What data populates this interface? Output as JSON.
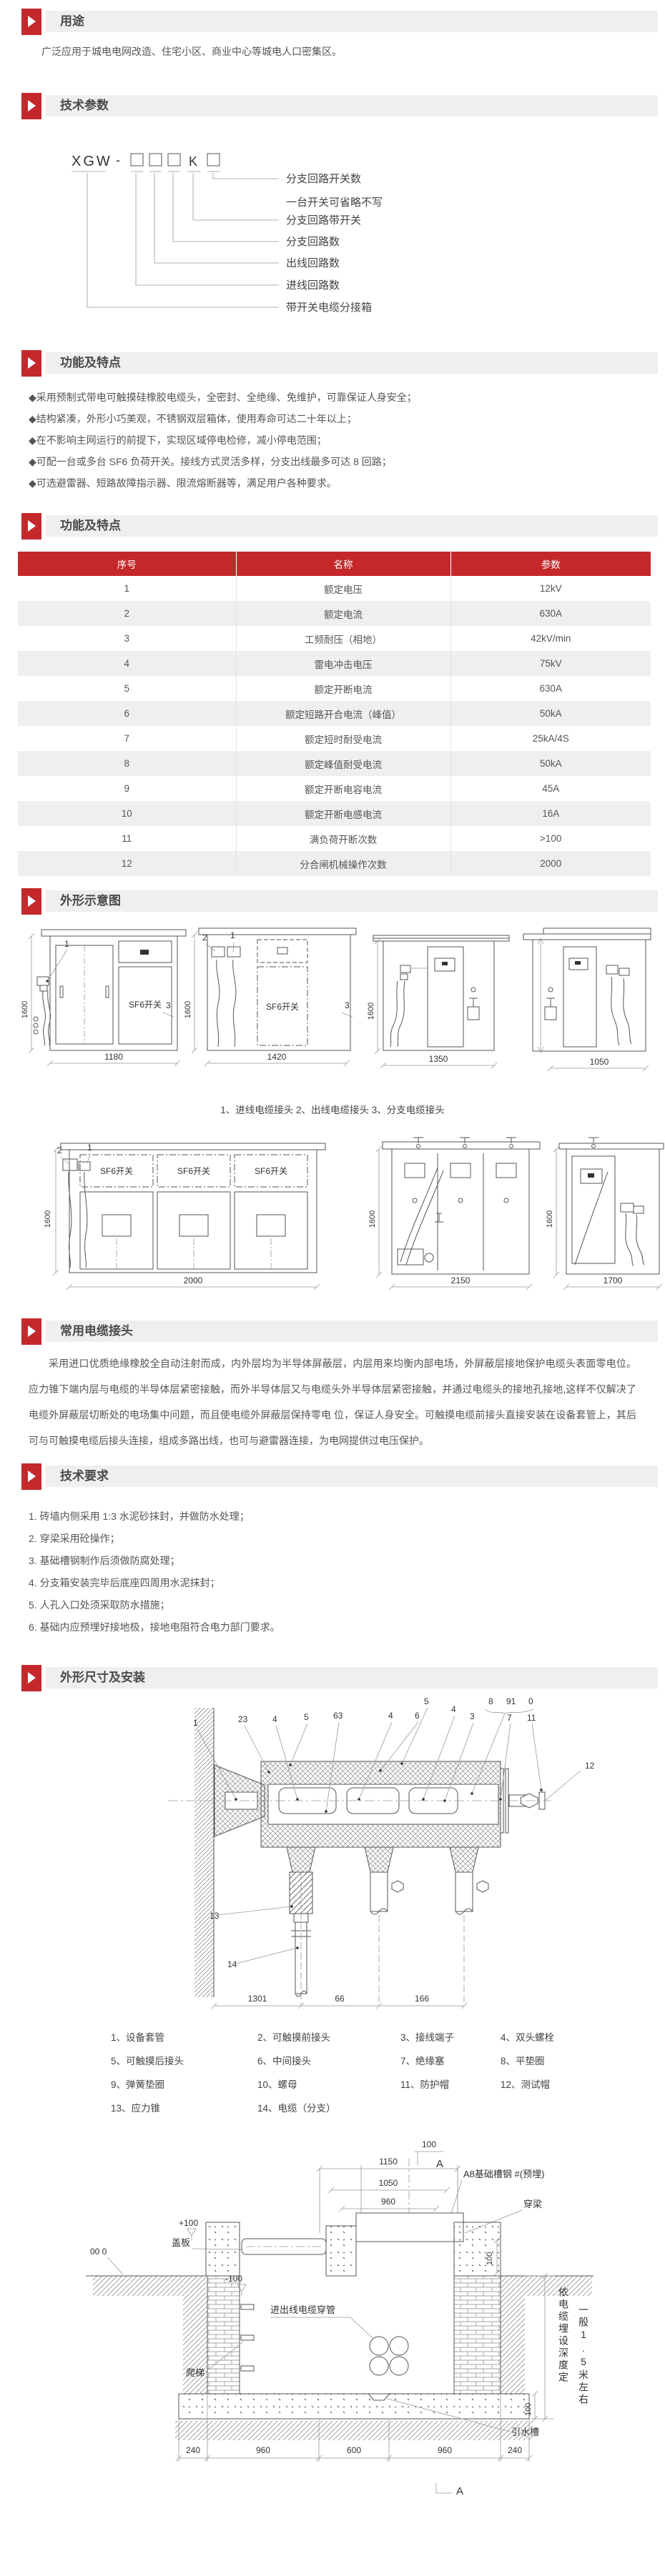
{
  "accent": "#c4282b",
  "purpose": {
    "title": "用途",
    "text": "广泛应用于城电电网改造、住宅小区、商业中心等城电人口密集区。"
  },
  "tech_params": {
    "title": "技术参数",
    "model_code": "XGW-□□□K□",
    "model": {
      "prefix": "XGW",
      "dash": "-",
      "box": "□",
      "k": "K"
    },
    "labels": [
      "分支回路开关数",
      "一台开关可省略不写",
      "分支回路带开关",
      "分支回路数",
      "出线回路数",
      "进线回路数",
      "带开关电缆分接箱"
    ]
  },
  "features": {
    "title": "功能及特点",
    "bullets": [
      "◆采用预制式带电可触摸硅橡胶电缆头，全密封、全绝缘、免维护，可靠保证人身安全；",
      "◆结构紧凑，外形小巧美观，不锈钢双层箱体，使用寿命可达二十年以上；",
      "◆在不影响主网运行的前提下，实现区域停电检修，减小停电范围；",
      "◆可配一台或多台 SF6 负荷开关。接线方式灵活多样，分支出线最多可达 8 回路；",
      "◆可选避雷器、短路故障指示器、限流熔断器等，满足用户各种要求。"
    ]
  },
  "params_table": {
    "title": "功能及特点",
    "headers": [
      "序号",
      "名称",
      "参数"
    ],
    "rows": [
      [
        "1",
        "额定电压",
        "12kV"
      ],
      [
        "2",
        "额定电流",
        "630A"
      ],
      [
        "3",
        "工频耐压（相地）",
        "42kV/min"
      ],
      [
        "4",
        "雷电冲击电压",
        "75kV"
      ],
      [
        "5",
        "额定开断电流",
        "630A"
      ],
      [
        "6",
        "额定短路开合电流（峰值）",
        "50kA"
      ],
      [
        "7",
        "额定短时耐受电流",
        "25kA/4S"
      ],
      [
        "8",
        "额定峰值耐受电流",
        "50kA"
      ],
      [
        "9",
        "额定开断电容电流",
        "45A"
      ],
      [
        "10",
        "额定开断电感电流",
        "16A"
      ],
      [
        "11",
        "满负荷开断次数",
        ">100"
      ],
      [
        "12",
        "分合闸机械操作次数",
        "2000"
      ]
    ]
  },
  "outline": {
    "title": "外形示意图",
    "caption": "1、进线电缆接头  2、出线电缆接头  3、分支电缆接头",
    "sf6": "SF6开关",
    "fig1": {
      "h": "1600",
      "w1": "1180",
      "w2": "1420",
      "w3": "1350",
      "w4": "1050",
      "c1": "1",
      "c2": "2",
      "c3": "3"
    },
    "fig2": {
      "h": "1600",
      "w1": "2000",
      "w2": "2150",
      "w3": "1700",
      "c1": "1",
      "c2": "2"
    }
  },
  "cable_joint": {
    "title": "常用电缆接头",
    "paragraph": "采用进口优质绝缘橡胶全自动注射而成，内外层均为半导体屏蔽层，内层用来均衡内部电场，外屏蔽层接地保护电缆头表面零电位。应力锥下端内层与电缆的半导体层紧密接触，而外半导体层又与电缆头外半导体层紧密接触，并通过电缆头的接地孔接地,这样不仅解决了电缆外屏蔽层切断处的电场集中问题，而且使电缆外屏蔽层保持零电 位，保证人身安全。可触摸电缆前接头直接安装在设备套管上，其后可与可触摸电缆后接头连接，组成多路出线，也可与避雷器连接，为电网提供过电压保护。"
  },
  "tech_req": {
    "title": "技术要求",
    "items": [
      "1. 砖墙内侧采用 1:3 水泥砂抹封，并做防水处理；",
      "2. 穿梁采用砼操作；",
      "3. 基础槽钢制作后须做防腐处理；",
      "4. 分支箱安装完毕后底座四周用水泥抹封；",
      "5. 人孔入口处须采取防水措施；",
      "6. 基础内应预埋好接地极，接地电阻符合电力部门要求。"
    ]
  },
  "install": {
    "title": "外形尺寸及安装",
    "connector": {
      "callouts": {
        "n1": "1",
        "n23": "23",
        "n4": "4",
        "n5": "5",
        "n63": "63",
        "n4b": "4",
        "n6": "6",
        "n5b": "5",
        "n4c": "4",
        "n3": "3",
        "n8": "8",
        "n91": "91",
        "n0": "0",
        "n7": "7",
        "n11": "11",
        "n12": "12",
        "n13": "13",
        "n14": "14"
      },
      "d1": "1301",
      "d2": "66",
      "d3": "166"
    },
    "legend": [
      "1、设备套管",
      "2、可触摸前接头",
      "3、接线端子",
      "4、双头螺栓",
      "5、可触摸后接头",
      "6、中间接头",
      "7、绝缘塞",
      "8、平垫圈",
      "9、弹簧垫圈",
      "10、螺母",
      "11、防护帽",
      "12、测试帽",
      "13、应力锥",
      "14、电缆（分支）"
    ],
    "foundation": {
      "t100": "100",
      "a_top": "A",
      "d1150": "1150",
      "d1050": "1050",
      "d960": "960",
      "cover": "盖板",
      "channel": "A8基础槽钢  #(预埋)",
      "beam": "穿梁",
      "p100": "+100",
      "zero": "00 0",
      "m100": "-100",
      "r100": "100",
      "conduit": "进出线电缆穿管",
      "ladder": "爬梯",
      "drain": "引水槽",
      "vtext1": "依电缆埋设深度定",
      "vtext2": "一般1.5米左右",
      "f100": "100",
      "b240": "240",
      "b960": "960",
      "b600": "600",
      "a_bottom": "A"
    }
  }
}
